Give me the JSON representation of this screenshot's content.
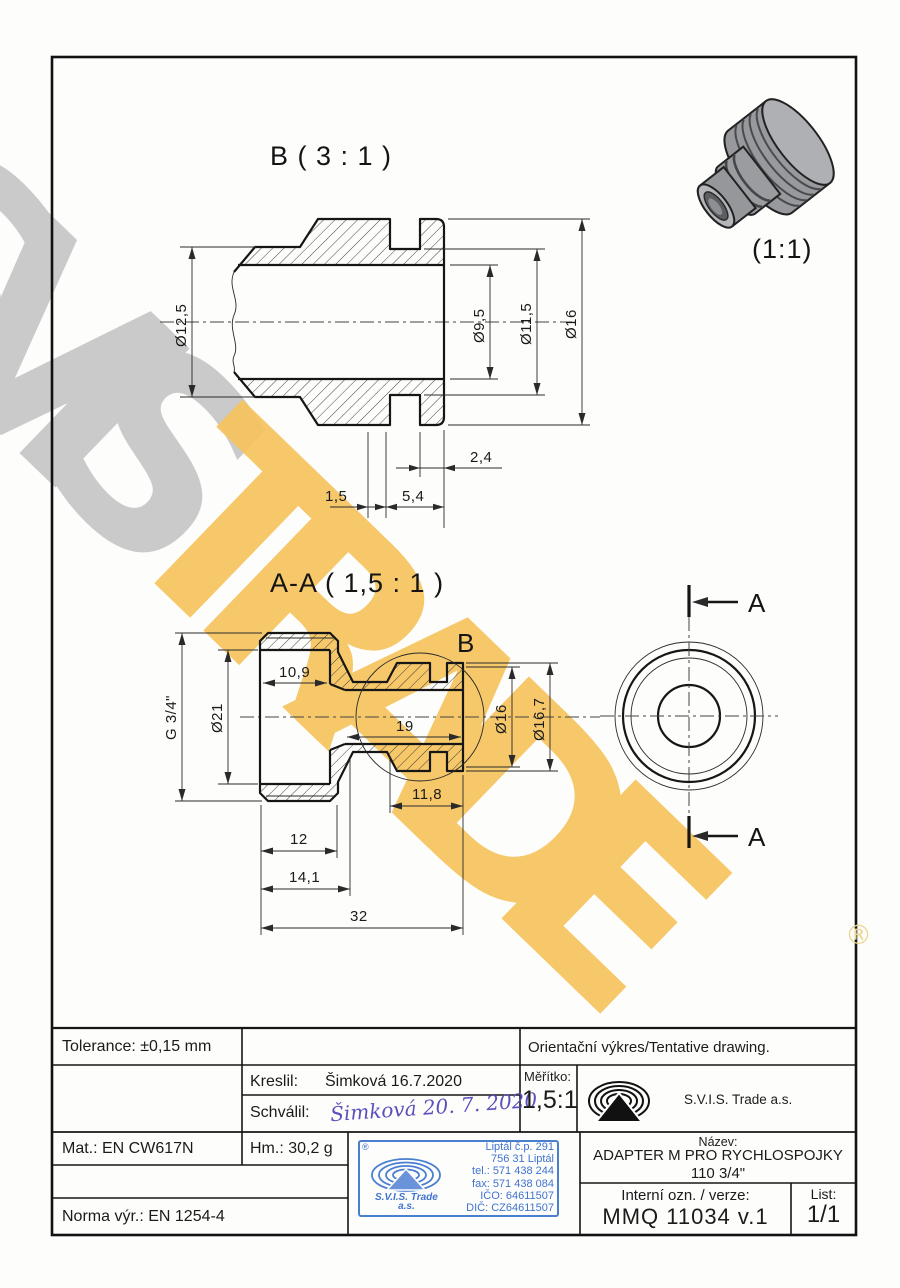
{
  "watermark": {
    "part1": "SVIS",
    "part2": "TRADE",
    "registered": "®",
    "gray_color": "#cacaca",
    "yellow_color": "#f6c45e"
  },
  "views": {
    "detail_b": {
      "label": "B ( 3 : 1 )",
      "dims": {
        "d125": "Ø12,5",
        "d95": "Ø9,5",
        "d115": "Ø11,5",
        "d16": "Ø16",
        "w24": "2,4",
        "w15": "1,5",
        "w54": "5,4"
      }
    },
    "section_aa": {
      "label": "A-A ( 1,5 : 1 )",
      "detail_marker": "B",
      "dims": {
        "thread": "G 3/4\"",
        "d21": "Ø21",
        "w109": "10,9",
        "w19": "19",
        "d16": "Ø16",
        "d167": "Ø16,7",
        "w118": "11,8",
        "w12": "12",
        "w141": "14,1",
        "w32": "32"
      }
    },
    "side_view": {
      "cut_label_top": "A",
      "cut_label_bottom": "A"
    },
    "iso_view": {
      "scale_label": "(1:1)"
    }
  },
  "title_block": {
    "tolerance": "Tolerance: ±0,15 mm",
    "orientation_note": "Orientační výkres/Tentative drawing.",
    "drawn_label": "Kreslil:",
    "drawn_value": "Šimková 16.7.2020",
    "approved_label": "Schválil:",
    "approved_value": "Šimková 20. 7. 2020",
    "scale_label": "Měřítko:",
    "scale_value": "1,5:1",
    "company": "S.V.I.S. Trade a.s.",
    "material": "Mat.: EN CW617N",
    "weight": "Hm.: 30,2 g",
    "norm": "Norma výr.: EN 1254-4",
    "name_label": "Název:",
    "name_line1": "ADAPTER M PRO RYCHLOSPOJKY",
    "name_line2": "110 3/4\"",
    "internal_label": "Interní ozn. / verze:",
    "internal_value": "MMQ 11034 v.1",
    "sheet_label": "List:",
    "sheet_value": "1/1",
    "stamp": {
      "registered": "®",
      "company_line1": "S.V.I.S. Trade",
      "company_line2": "a.s.",
      "lines": [
        "Liptál č.p. 291",
        "756 31 Liptál",
        "tel.: 571 438 244",
        "fax: 571 438 084",
        "IČO: 64611507",
        "DIČ: CZ64611507"
      ],
      "color": "#4a7fd0"
    }
  }
}
